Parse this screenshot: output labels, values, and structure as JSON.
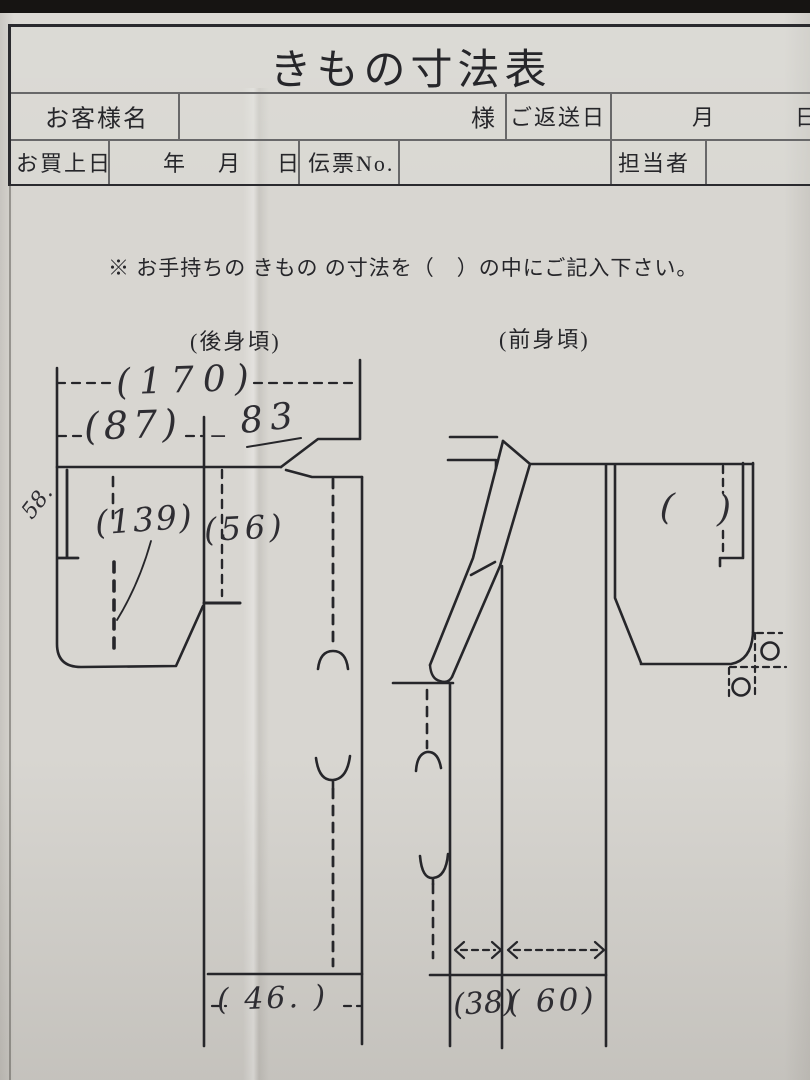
{
  "page": {
    "title": "きもの寸法表"
  },
  "header": {
    "customer_name_label": "お客様名",
    "customer_suffix": "様",
    "return_date_label": "ご返送日",
    "return_month": "月",
    "return_day": "日",
    "purchase_date_label": "お買上日",
    "purchase_year": "年",
    "purchase_month": "月",
    "purchase_day": "日",
    "slip_no_label": "伝票No.",
    "staff_label": "担当者"
  },
  "note": "※ お手持ちの きもの の寸法を（　）の中にご記入下さい。",
  "back_panel": {
    "label": "(後身頃)",
    "values": {
      "total_width": "(170)",
      "width_87": "(87)",
      "dash_mark": "−",
      "val_83": "83",
      "sleeve_length": "58.",
      "val_139": "(139)",
      "val_56": "(56)",
      "hem_width": "( 46. )"
    }
  },
  "front_panel": {
    "label": "(前身頃)",
    "values": {
      "empty_paren_open": "(",
      "empty_paren_close": ")",
      "front_width": "(38)",
      "val_60": "( 60)"
    }
  },
  "colors": {
    "ink": "#26262a",
    "paper": "#d8d6d1",
    "scan_band": "#161412"
  }
}
